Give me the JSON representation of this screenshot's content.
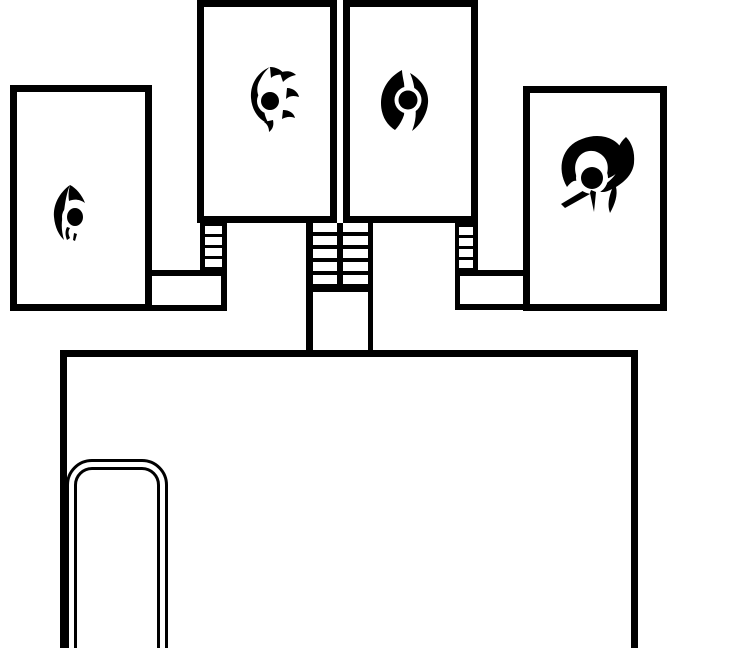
{
  "map": {
    "type": "dungeon-floor-plan",
    "background_color": "#ffffff",
    "line_color": "#000000",
    "rooms": [
      {
        "name": "west-chamber",
        "icon": "flame-sigil-icon"
      },
      {
        "name": "north-west-chamber",
        "icon": "pinwheel-sigil-icon"
      },
      {
        "name": "north-east-chamber",
        "icon": "twin-crescent-sigil-icon"
      },
      {
        "name": "east-chamber",
        "icon": "horn-swirl-sigil-icon"
      },
      {
        "name": "great-hall",
        "icon": ""
      }
    ],
    "connectors": [
      {
        "name": "west-stairs"
      },
      {
        "name": "center-west-stairs"
      },
      {
        "name": "center-east-stairs"
      },
      {
        "name": "east-stairs"
      },
      {
        "name": "west-corridor"
      },
      {
        "name": "center-corridor"
      },
      {
        "name": "east-corridor"
      }
    ],
    "furniture": [
      {
        "name": "rounded-alcove"
      }
    ]
  }
}
